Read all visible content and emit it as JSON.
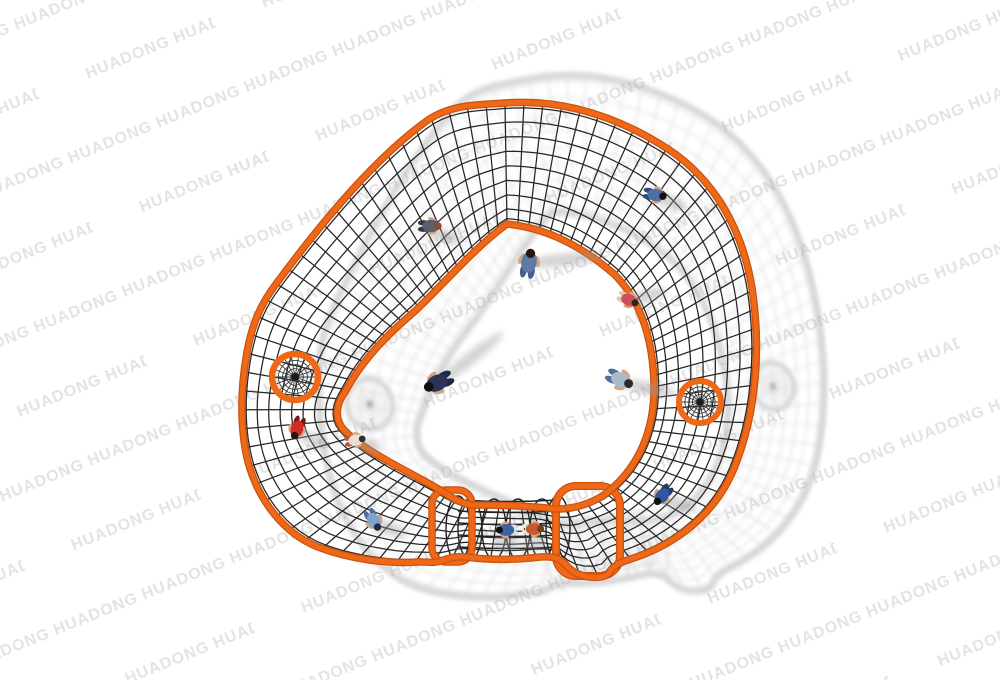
{
  "scene": {
    "alt": "Top view 3D render of an orange-framed rope climbing net playground structure shaped like a rounded triangular ring, with two spider-web net circles, a bottom rope crawl tunnel, children playing on the nets and people standing inside, soft gray shadows cast to the right, on a white background with repeated HUADONG watermarks"
  },
  "watermark": {
    "text": "HUADONG",
    "color": "#e3e3e3"
  },
  "palette": {
    "ground": "#ffffff",
    "frame_orange": "#ef6817",
    "frame_orange_dark": "#c9530e",
    "frame_orange_light": "#f8823a",
    "net_rope": "#252525",
    "web_rope": "#3a3a3a",
    "shadow_gray": "#b0b0b0",
    "figure_shadow": "#9a9a9a",
    "skin": "#d9a57f"
  },
  "figures": [
    {
      "id": "kid-on-top-band",
      "x": 431,
      "y": 226,
      "rot": 90,
      "size": 1.0,
      "shirt": "#5a5f6b",
      "pants": "#313844",
      "hair": "#8a4a2c",
      "shadow": {
        "dx": 14,
        "dy": 10,
        "len": 18,
        "rot": 15
      }
    },
    {
      "id": "stander-center",
      "x": 529,
      "y": 262,
      "rot": 10,
      "size": 1.25,
      "shirt": "#5e7ba3",
      "pants": "#44618c",
      "hair": "#26180f",
      "shadow": {
        "dx": 34,
        "dy": -2,
        "len": 40,
        "rot": -6
      }
    },
    {
      "id": "kid-right-top-band",
      "x": 656,
      "y": 195,
      "rot": 100,
      "size": 1.0,
      "shirt": "#4d6fa8",
      "pants": "#2f4c78",
      "hair": "#17120d",
      "shadow": {
        "dx": 16,
        "dy": 8,
        "len": 16,
        "rot": 20
      }
    },
    {
      "id": "kid-inside-right",
      "x": 629,
      "y": 300,
      "rot": 115,
      "size": 0.95,
      "shirt": "#cf4f5c",
      "pants": "#e3c6b4",
      "hair": "#33241a",
      "shadow": {
        "dx": 18,
        "dy": -4,
        "len": 20,
        "rot": -15
      }
    },
    {
      "id": "walker-navy",
      "x": 437,
      "y": 383,
      "rot": 245,
      "size": 1.3,
      "shirt": "#2b3457",
      "pants": "#1f2947",
      "hair": "#101018",
      "shadow": {
        "dx": 30,
        "dy": -22,
        "len": 46,
        "rot": -38
      }
    },
    {
      "id": "person-inside-bottom-right",
      "x": 621,
      "y": 380,
      "rot": 115,
      "size": 1.2,
      "shirt": "#a9bac9",
      "pants": "#4f6f9b",
      "hair": "#2b2b2b",
      "shadow": {
        "dx": 26,
        "dy": 8,
        "len": 30,
        "rot": 12
      }
    },
    {
      "id": "kid-left-band-red",
      "x": 297,
      "y": 429,
      "rot": 200,
      "size": 1.0,
      "shirt": "#d22b22",
      "pants": "#7d1a16",
      "hair": "#1a1a1a",
      "shadow": {
        "dx": 14,
        "dy": 10,
        "len": 16,
        "rot": 25
      }
    },
    {
      "id": "kid-bottom-left-band",
      "x": 374,
      "y": 521,
      "rot": 150,
      "size": 1.0,
      "shirt": "#7fa3cc",
      "pants": "#4e6f9e",
      "hair": "#202c3f",
      "shadow": {
        "dx": 16,
        "dy": 8,
        "len": 18,
        "rot": 15
      }
    },
    {
      "id": "kid-tunnel-a",
      "x": 506,
      "y": 530,
      "rot": 270,
      "size": 0.95,
      "shirt": "#3f5fa5",
      "pants": "#d8dde6",
      "hair": "#101010",
      "shadow": {
        "dx": 0,
        "dy": 14,
        "len": 14,
        "rot": 0
      }
    },
    {
      "id": "kid-tunnel-b",
      "x": 534,
      "y": 529,
      "rot": 90,
      "size": 0.95,
      "shirt": "#c9572f",
      "pants": "#e8e4de",
      "hair": "#6e3f1e",
      "shadow": {
        "dx": 0,
        "dy": 14,
        "len": 12,
        "rot": 0
      }
    },
    {
      "id": "kid-bottom-right-band",
      "x": 662,
      "y": 496,
      "rot": 220,
      "size": 1.0,
      "shirt": "#2f57a0",
      "pants": "#20396b",
      "hair": "#101010",
      "shadow": {
        "dx": 16,
        "dy": 8,
        "len": 18,
        "rot": 15
      }
    },
    {
      "id": "kid-inner-edge",
      "x": 356,
      "y": 440,
      "rot": 80,
      "size": 0.9,
      "shirt": "#e9dfd3",
      "pants": "#b8504b",
      "hair": "#2e2e2e",
      "shadow": {
        "dx": 12,
        "dy": 6,
        "len": 14,
        "rot": 10
      }
    }
  ]
}
